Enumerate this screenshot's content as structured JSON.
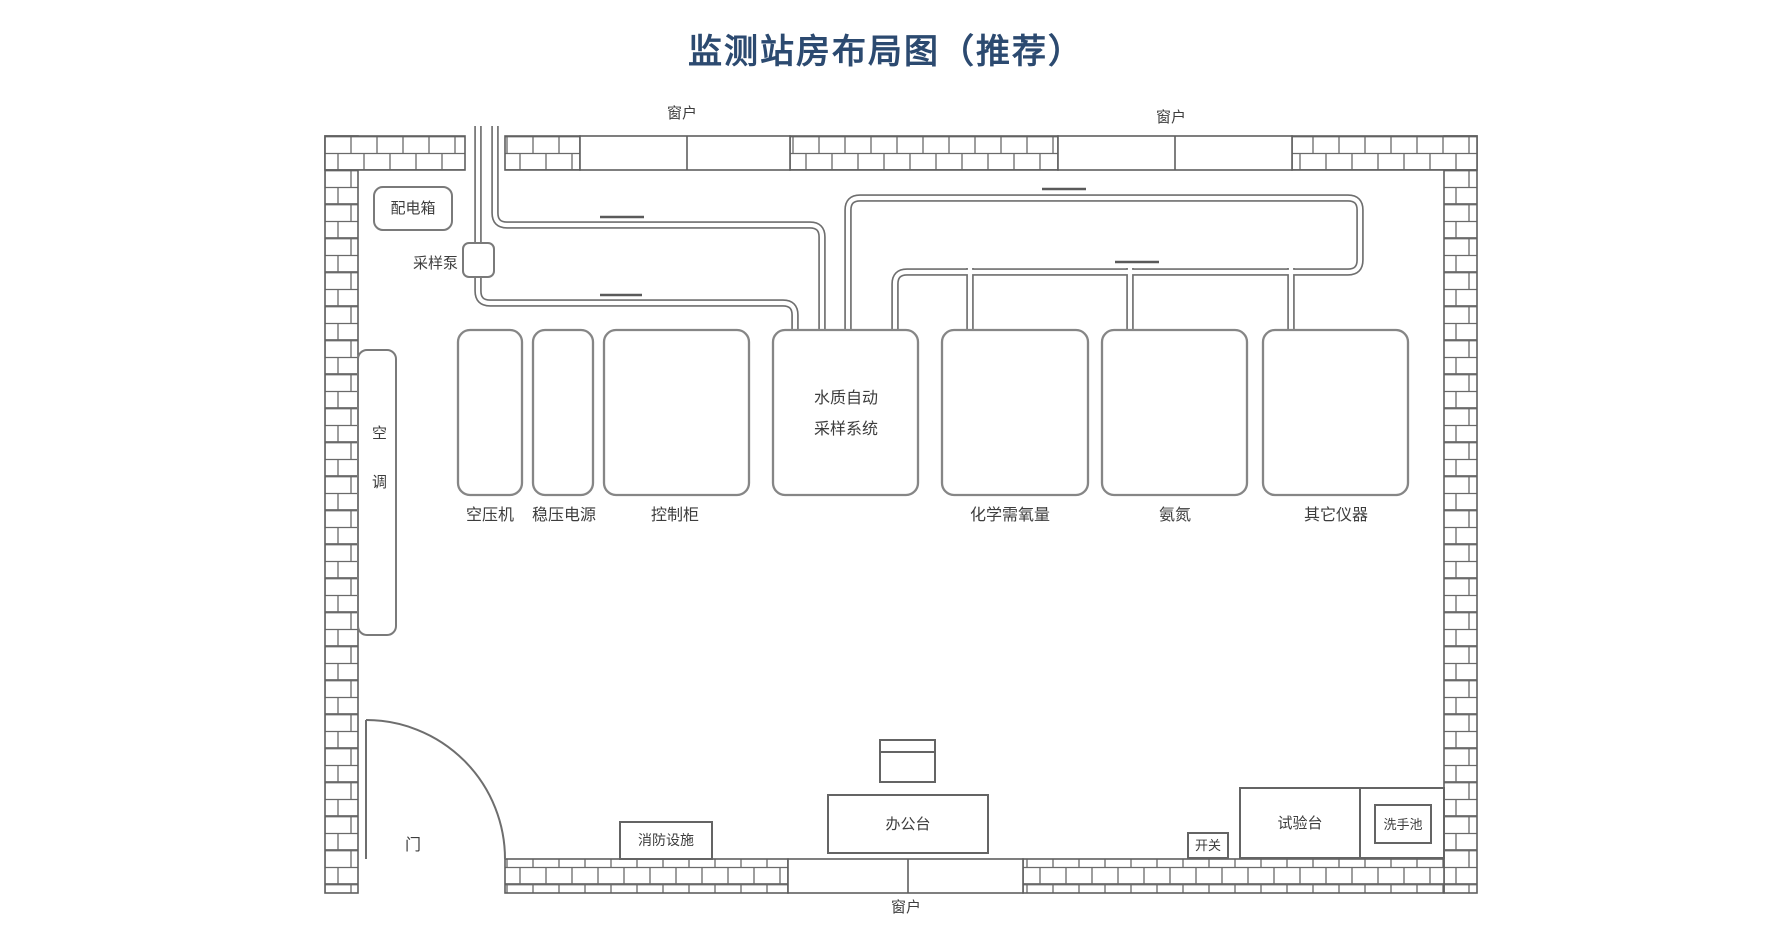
{
  "title": "监测站房布局图（推荐）",
  "windows": {
    "top_left": "窗户",
    "top_right": "窗户",
    "bottom": "窗户"
  },
  "door_label": "门",
  "equipment": {
    "distribution_box": "配电箱",
    "sampling_pump": "采样泵",
    "air_conditioner": "空调",
    "air_compressor": "空压机",
    "regulated_power_supply": "稳压电源",
    "control_cabinet": "控制柜",
    "water_auto_sampling_system": "水质自动采样系统",
    "cod_analyzer": "化学需氧量",
    "ammonia_nitrogen": "氨氮",
    "other_instruments": "其它仪器",
    "fire_equipment": "消防设施",
    "office_desk": "办公台",
    "switch": "开关",
    "test_bench": "试验台",
    "sink": "洗手池"
  },
  "colors": {
    "title": "#2c4a70",
    "line": "#6b6b6b",
    "wall_line": "#5f5f5f",
    "text": "#3d3d3d",
    "background": "#ffffff"
  }
}
